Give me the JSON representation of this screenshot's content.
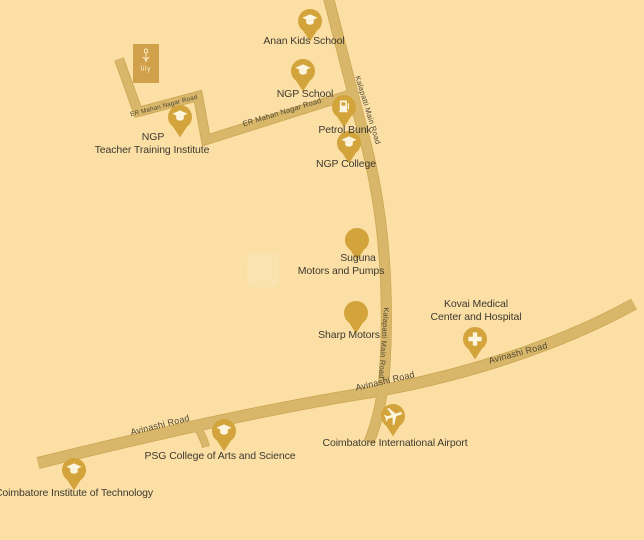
{
  "map": {
    "colors": {
      "background": "#FBDFA4",
      "road": "#D9B76A",
      "road_edge": "#C9A551",
      "pin": "#D3A43C",
      "pin_icon": "#FDF5DE",
      "label_text": "#3E3A31",
      "road_label_text": "#4E4734",
      "logo_bg": "#D0A04A"
    },
    "logo": {
      "text": "lily",
      "icon": "tulip-flower-icon"
    },
    "road_labels": {
      "er_mahan_nagar_road": "ER Mahan Nagar Road",
      "kalapatti_main_road": "Kalapatti Main Road",
      "avinashi_road": "Avinashi Road"
    },
    "places": [
      {
        "id": "anan-kids-school",
        "icon": "graduation-cap",
        "lines": [
          "Anan Kids School"
        ]
      },
      {
        "id": "ngp-school",
        "icon": "graduation-cap",
        "lines": [
          "NGP School"
        ]
      },
      {
        "id": "petrol-bunk",
        "icon": "fuel-pump",
        "lines": [
          "Petrol Bunk"
        ]
      },
      {
        "id": "ngp-college",
        "icon": "graduation-cap",
        "lines": [
          "NGP College"
        ]
      },
      {
        "id": "ngp-teacher-training-institute",
        "icon": "graduation-cap",
        "lines": [
          "NGP",
          "Teacher Training Institute"
        ]
      },
      {
        "id": "suguna-motors-and-pumps",
        "icon": "none",
        "lines": [
          "Suguna",
          "Motors and Pumps"
        ]
      },
      {
        "id": "sharp-motors",
        "icon": "none",
        "lines": [
          "Sharp Motors"
        ]
      },
      {
        "id": "kovai-medical-center-and-hospital",
        "icon": "medical-cross",
        "lines": [
          "Kovai Medical",
          "Center and Hospital"
        ]
      },
      {
        "id": "coimbatore-international-airport",
        "icon": "airplane",
        "lines": [
          "Coimbatore International Airport"
        ]
      },
      {
        "id": "psg-college-of-arts-and-science",
        "icon": "graduation-cap",
        "lines": [
          "PSG College of Arts and Science"
        ]
      },
      {
        "id": "coimbatore-institute-of-technology",
        "icon": "graduation-cap",
        "lines": [
          "Coimbatore Institute of Technology"
        ]
      }
    ]
  }
}
